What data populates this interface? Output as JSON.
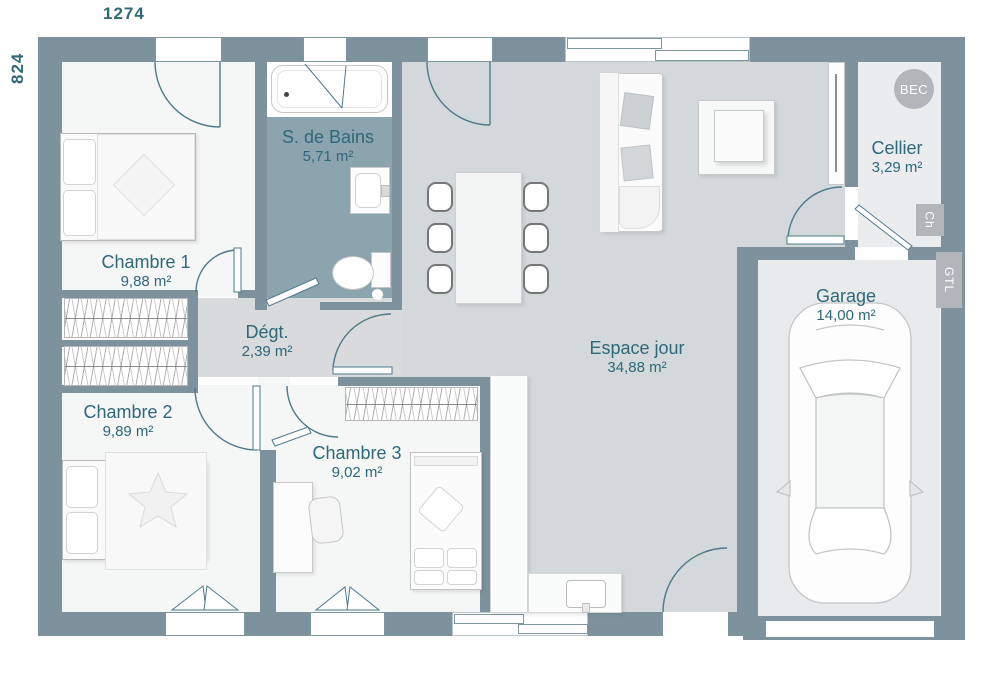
{
  "plan": {
    "dimensions": {
      "width": "1274",
      "height": "824"
    },
    "rooms": {
      "chambre1": {
        "name": "Chambre 1",
        "area": "9,88 m²"
      },
      "sdb": {
        "name": "S. de Bains",
        "area": "5,71 m²"
      },
      "degt": {
        "name": "Dégt.",
        "area": "2,39 m²"
      },
      "chambre2": {
        "name": "Chambre 2",
        "area": "9,89 m²"
      },
      "chambre3": {
        "name": "Chambre 3",
        "area": "9,02 m²"
      },
      "espace": {
        "name": "Espace jour",
        "area": "34,88 m²"
      },
      "cellier": {
        "name": "Cellier",
        "area": "3,29 m²"
      },
      "garage": {
        "name": "Garage",
        "area": "14,00 m²"
      }
    },
    "badges": {
      "bec": "BEC",
      "ch": "Ch",
      "gtl": "GTL"
    },
    "colors": {
      "wall": "#7e929d",
      "espace": "#d3d8db",
      "hall": "#d8dadb",
      "bath": "#8ca4ae",
      "room": "#f5f6f6",
      "cellier": "#eaecee",
      "garage": "#e8eaec",
      "ink": "#2e6879",
      "arc": "#4e7a8a",
      "frame": "#7d97a2",
      "badge": "#b2b5b9"
    }
  }
}
